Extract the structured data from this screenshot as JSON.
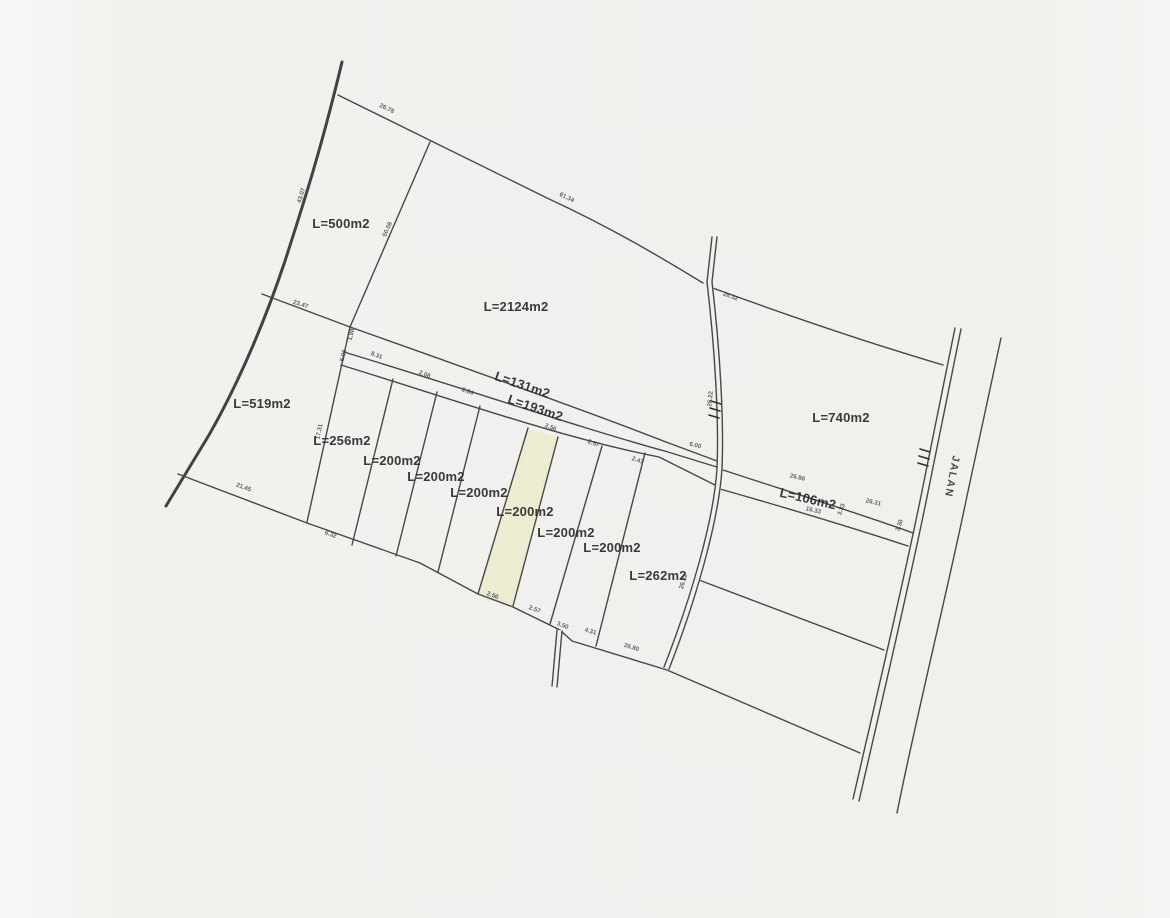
{
  "document": {
    "kind": "scanned land parcel survey plan",
    "background_color": "#f1f0ed",
    "line_color": "#474747",
    "highlight_fill": "#ebecd0"
  },
  "road": {
    "label": "JALAN",
    "x": 949,
    "y": 476,
    "rot": 101
  },
  "parcels": [
    {
      "label": "L=500m2",
      "x": 341,
      "y": 228,
      "rot": 0
    },
    {
      "label": "L=2124m2",
      "x": 516,
      "y": 311,
      "rot": 0
    },
    {
      "label": "L=519m2",
      "x": 262,
      "y": 408,
      "rot": 0
    },
    {
      "label": "L=740m2",
      "x": 841,
      "y": 422,
      "rot": 0
    },
    {
      "label": "L=131m2",
      "x": 521,
      "y": 389,
      "rot": 19
    },
    {
      "label": "L=193m2",
      "x": 534,
      "y": 412,
      "rot": 19
    },
    {
      "label": "L=256m2",
      "x": 342,
      "y": 445,
      "rot": 0
    },
    {
      "label": "L=200m2",
      "x": 392,
      "y": 465,
      "rot": 0
    },
    {
      "label": "L=200m2",
      "x": 436,
      "y": 481,
      "rot": 0
    },
    {
      "label": "L=200m2",
      "x": 479,
      "y": 497,
      "rot": 0
    },
    {
      "label": "L=200m2",
      "x": 525,
      "y": 516,
      "rot": 0,
      "highlighted": true
    },
    {
      "label": "L=200m2",
      "x": 566,
      "y": 537,
      "rot": 0
    },
    {
      "label": "L=200m2",
      "x": 612,
      "y": 552,
      "rot": 0
    },
    {
      "label": "L=262m2",
      "x": 658,
      "y": 580,
      "rot": 0
    },
    {
      "label": "L=106m2",
      "x": 807,
      "y": 503,
      "rot": 13
    }
  ],
  "dimensions": [
    {
      "label": "26.78",
      "x": 386,
      "y": 110,
      "rot": 26
    },
    {
      "label": "61.34",
      "x": 566,
      "y": 199,
      "rot": 26
    },
    {
      "label": "43.07",
      "x": 303,
      "y": 196,
      "rot": -73
    },
    {
      "label": "50.08",
      "x": 389,
      "y": 230,
      "rot": -66
    },
    {
      "label": "23.47",
      "x": 300,
      "y": 306,
      "rot": 18
    },
    {
      "label": "1.98",
      "x": 353,
      "y": 335,
      "rot": -75
    },
    {
      "label": "5.00",
      "x": 345,
      "y": 356,
      "rot": -75
    },
    {
      "label": "8.31",
      "x": 376,
      "y": 357,
      "rot": 21
    },
    {
      "label": "2.08",
      "x": 424,
      "y": 376,
      "rot": 21
    },
    {
      "label": "2.84",
      "x": 467,
      "y": 393,
      "rot": 21
    },
    {
      "label": "17.31",
      "x": 321,
      "y": 432,
      "rot": -78
    },
    {
      "label": "21.45",
      "x": 243,
      "y": 489,
      "rot": 21
    },
    {
      "label": "6.32",
      "x": 330,
      "y": 536,
      "rot": 21
    },
    {
      "label": "2.56",
      "x": 550,
      "y": 429,
      "rot": 21
    },
    {
      "label": "2.57",
      "x": 593,
      "y": 445,
      "rot": 21
    },
    {
      "label": "2.47",
      "x": 637,
      "y": 462,
      "rot": 21
    },
    {
      "label": "6.00",
      "x": 695,
      "y": 447,
      "rot": 13
    },
    {
      "label": "26.32",
      "x": 730,
      "y": 298,
      "rot": 20
    },
    {
      "label": "26.22",
      "x": 712,
      "y": 399,
      "rot": -84
    },
    {
      "label": "26.22",
      "x": 685,
      "y": 582,
      "rot": -74
    },
    {
      "label": "2.56",
      "x": 492,
      "y": 597,
      "rot": 21
    },
    {
      "label": "2.57",
      "x": 534,
      "y": 611,
      "rot": 21
    },
    {
      "label": "3.50",
      "x": 562,
      "y": 627,
      "rot": 21
    },
    {
      "label": "4.31",
      "x": 590,
      "y": 633,
      "rot": 17
    },
    {
      "label": "26.80",
      "x": 631,
      "y": 649,
      "rot": 17
    },
    {
      "label": "26.86",
      "x": 797,
      "y": 479,
      "rot": 13
    },
    {
      "label": "16.33",
      "x": 813,
      "y": 512,
      "rot": 13
    },
    {
      "label": "3.33",
      "x": 843,
      "y": 510,
      "rot": -70
    },
    {
      "label": "26.31",
      "x": 873,
      "y": 504,
      "rot": 13
    },
    {
      "label": "3.30",
      "x": 901,
      "y": 526,
      "rot": -70
    }
  ]
}
